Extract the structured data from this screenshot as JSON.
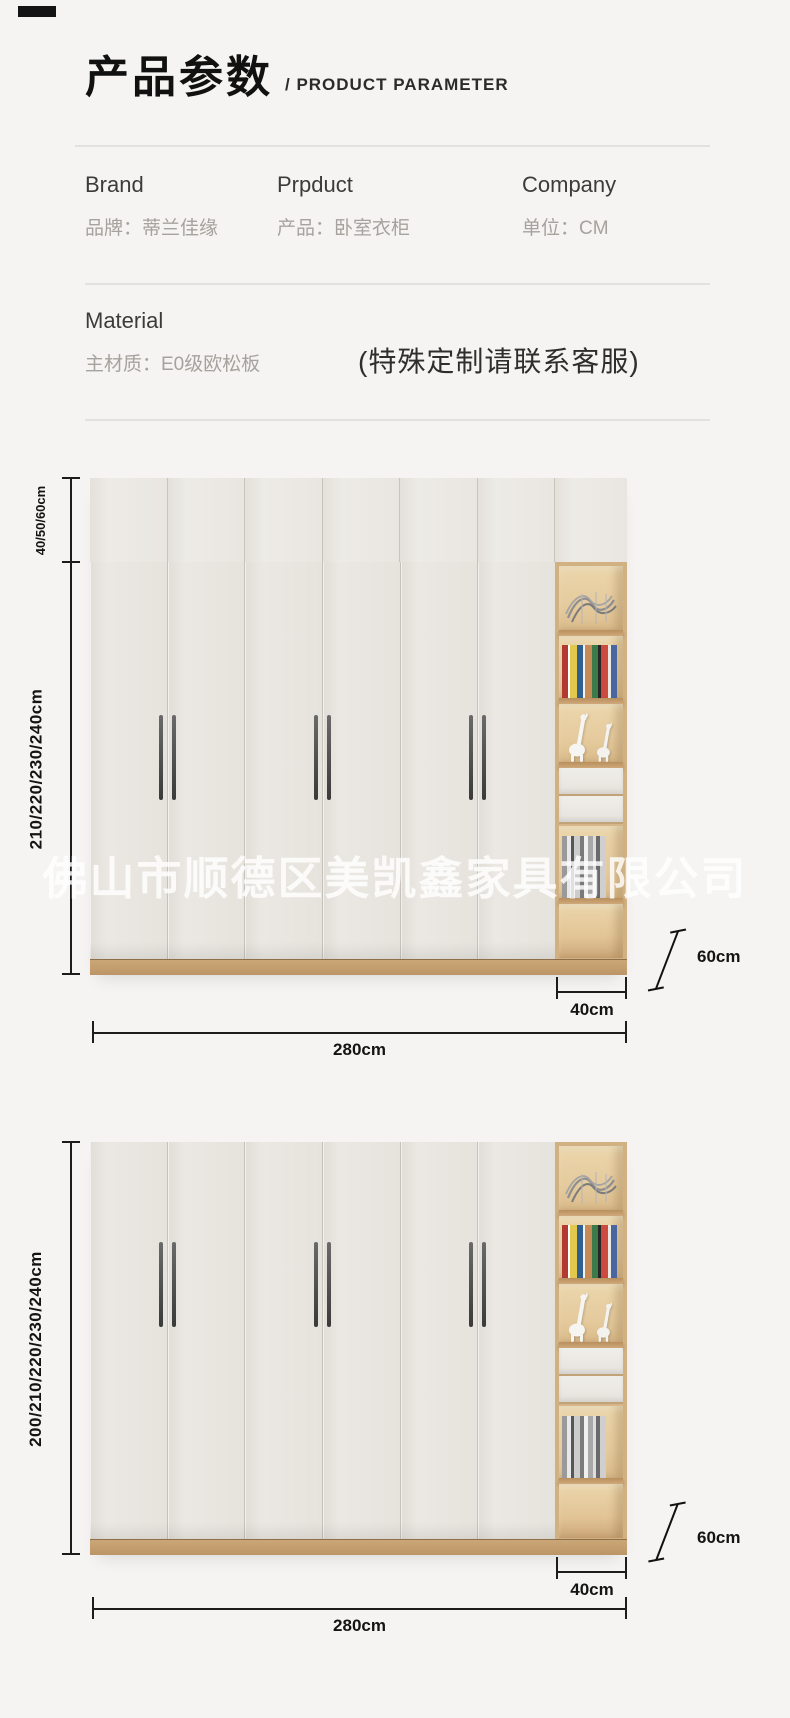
{
  "header": {
    "title_zh": "产品参数",
    "title_en": "/ PRODUCT PARAMETER"
  },
  "info": {
    "columns": [
      {
        "label_en": "Brand",
        "label_zh": "品牌：蒂兰佳缘"
      },
      {
        "label_en": "Prpduct",
        "label_zh": "产品：卧室衣柜"
      },
      {
        "label_en": "Company",
        "label_zh": "单位：CM"
      }
    ]
  },
  "material": {
    "label_en": "Material",
    "label_zh": "主材质：E0级欧松板",
    "note": "(特殊定制请联系客服)"
  },
  "watermark": {
    "text": "佛山市顺德区美凯鑫家具有限公司"
  },
  "diagram1": {
    "top_section_height": "40/50/60cm",
    "body_height": "210/220/230/240cm",
    "depth": "60cm",
    "side_cabinet_width": "40cm",
    "total_width": "280cm"
  },
  "diagram2": {
    "body_height": "200/210/220/230/240cm",
    "depth": "60cm",
    "side_cabinet_width": "40cm",
    "total_width": "280cm"
  },
  "colors": {
    "background": "#f5f4f2",
    "door": "#e8e5e0",
    "wood": "#d6b689",
    "dimension_line": "#1c1c1c"
  }
}
